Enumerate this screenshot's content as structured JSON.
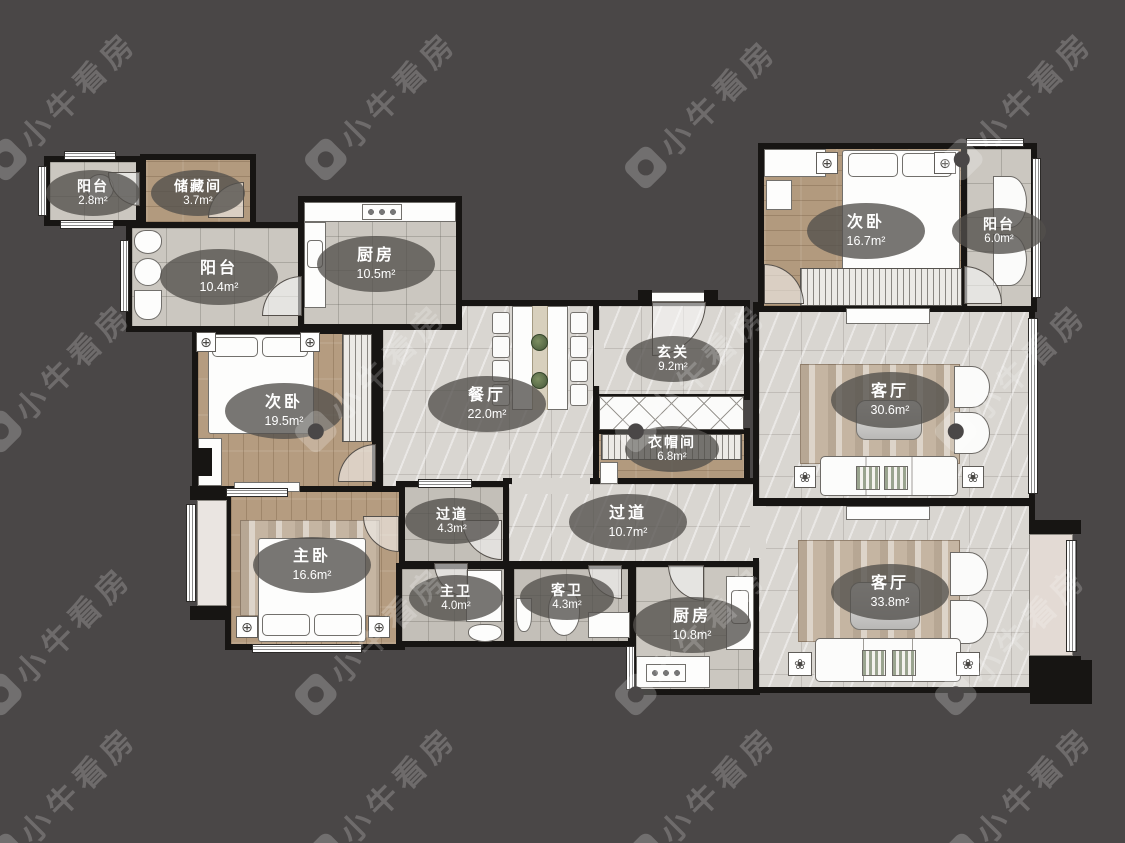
{
  "watermark": {
    "text": "小牛看房"
  },
  "icons": {
    "ceiling_lamp": "⊕",
    "flower": "❀"
  },
  "colors": {
    "background": "#4a4747",
    "wall": "#171513",
    "label_pill": "rgba(82,79,76,0.78)",
    "tile_floor": "#cbc7c0",
    "marble_floor": "#d9d6d1",
    "wood_floor": "#b59c80"
  },
  "rooms": {
    "balcony_tl": {
      "name": "阳台",
      "area": "2.8m²"
    },
    "storage": {
      "name": "储藏间",
      "area": "3.7m²"
    },
    "balcony_left": {
      "name": "阳台",
      "area": "10.4m²"
    },
    "kitchen_top": {
      "name": "厨房",
      "area": "10.5m²"
    },
    "bedroom_left": {
      "name": "次卧",
      "area": "19.5m²"
    },
    "dining": {
      "name": "餐厅",
      "area": "22.0m²"
    },
    "foyer": {
      "name": "玄关",
      "area": "9.2m²"
    },
    "cloakroom": {
      "name": "衣帽间",
      "area": "6.8m²"
    },
    "bedroom_tr": {
      "name": "次卧",
      "area": "16.7m²"
    },
    "balcony_right": {
      "name": "阳台",
      "area": "6.0m²"
    },
    "living_upper": {
      "name": "客厅",
      "area": "30.6m²"
    },
    "master_bedroom": {
      "name": "主卧",
      "area": "16.6m²"
    },
    "hall_small": {
      "name": "过道",
      "area": "4.3m²"
    },
    "master_bath": {
      "name": "主卫",
      "area": "4.0m²"
    },
    "hall_main": {
      "name": "过道",
      "area": "10.7m²"
    },
    "guest_bath": {
      "name": "客卫",
      "area": "4.3m²"
    },
    "kitchen_bottom": {
      "name": "厨房",
      "area": "10.8m²"
    },
    "living_lower": {
      "name": "客厅",
      "area": "33.8m²"
    }
  }
}
